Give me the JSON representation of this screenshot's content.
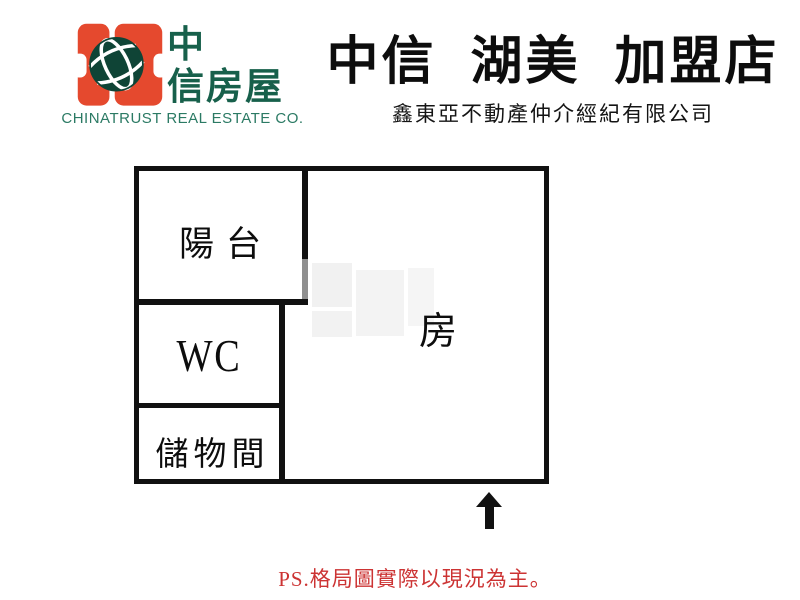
{
  "brand": {
    "logo_cjk_top": "中",
    "logo_cjk_bottom": "信房屋",
    "company_en": "CHINATRUST REAL ESTATE CO.",
    "colors": {
      "orange": "#E5492E",
      "text_green": "#17604B",
      "globe_green": "#0F4436"
    }
  },
  "store": {
    "title": "中信 湖美 加盟店",
    "subtitle": "鑫東亞不動產仲介經紀有限公司"
  },
  "floorplan": {
    "rooms": {
      "balcony": "陽台",
      "wc": "WC",
      "storage": "儲物間",
      "main": "房"
    },
    "wall_color": "#111111",
    "door_color": "#8F8F8F",
    "entrance_arrow_direction": "up"
  },
  "footer": {
    "note": "PS.格局圖實際以現況為主。",
    "color": "#CC3333"
  }
}
